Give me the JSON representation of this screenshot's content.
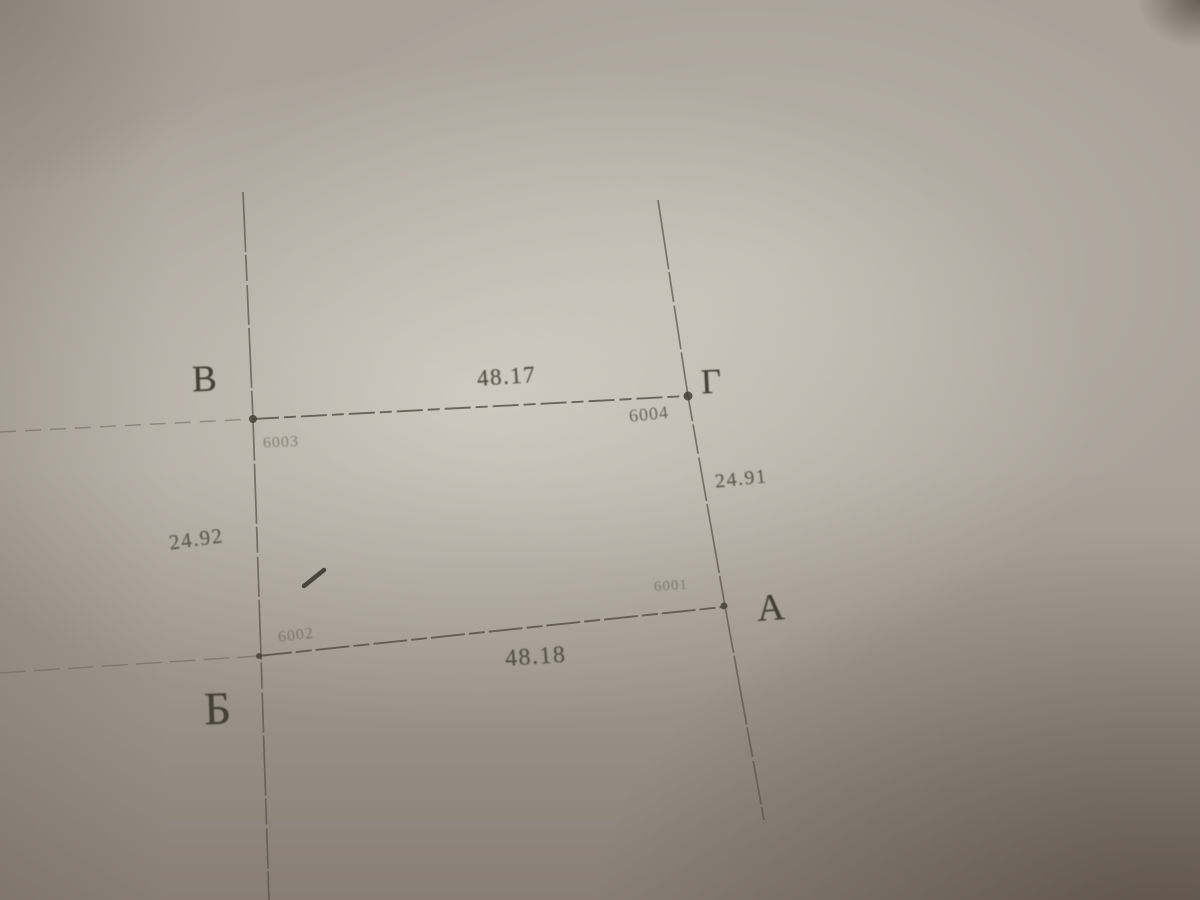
{
  "diagram": {
    "type": "land-parcel-boundary-sketch",
    "corners": [
      {
        "label": "В",
        "point_id": "6003",
        "position": "top-left"
      },
      {
        "label": "Г",
        "point_id": "6004",
        "position": "top-right"
      },
      {
        "label": "А",
        "point_id": "6001",
        "position": "bottom-right"
      },
      {
        "label": "Б",
        "point_id": "6002",
        "position": "bottom-left"
      }
    ],
    "side_lengths": {
      "top": "48.17",
      "right": "24.91",
      "bottom": "48.18",
      "left": "24.92"
    },
    "colors": {
      "ink": "#453e35",
      "faded_ink": "#6b635a",
      "paper": "#aaa299",
      "shadow": "#4a3a2c"
    }
  }
}
